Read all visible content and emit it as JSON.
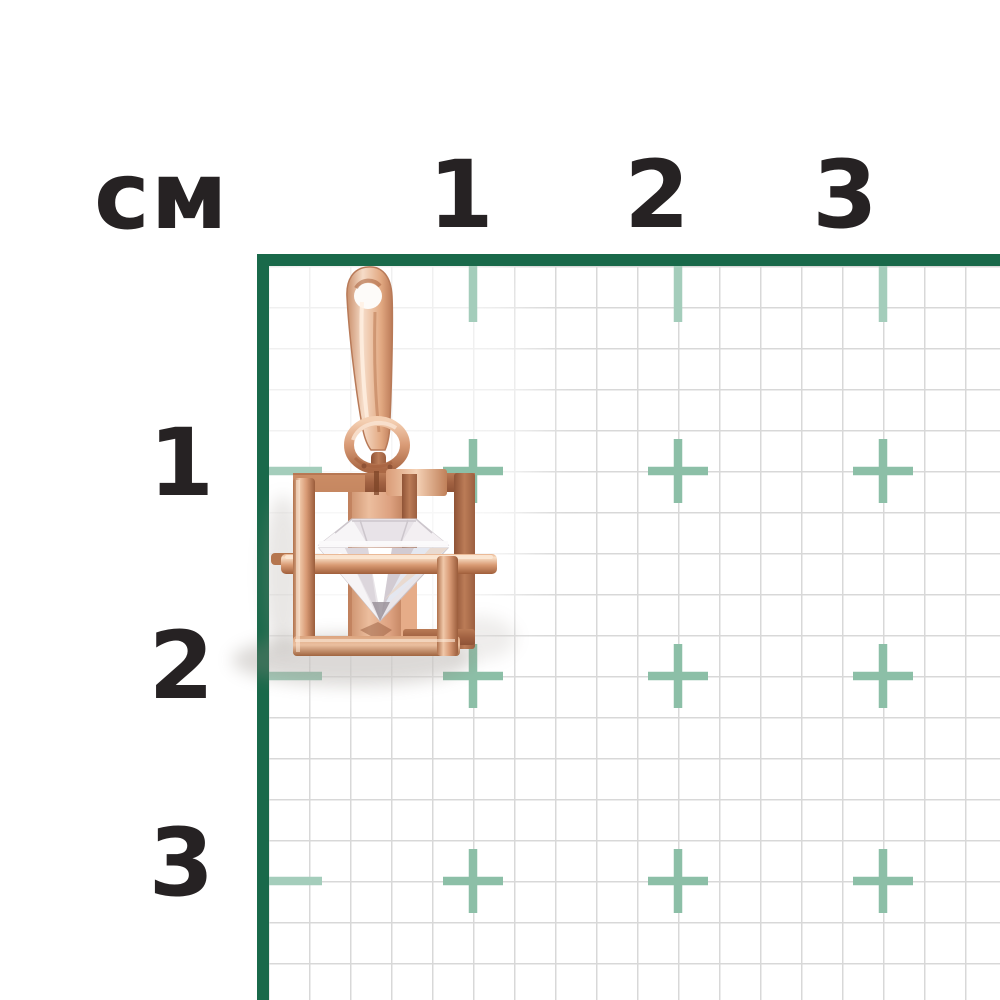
{
  "ruler": {
    "unit_label": "см",
    "top_ticks": [
      "1",
      "2",
      "3"
    ],
    "left_ticks": [
      "1",
      "2",
      "3"
    ],
    "cm_spacing_px": 205,
    "small_cell_mm": 2,
    "colors": {
      "frame_green": "#19694a",
      "cross_marks": "#8cbfa7",
      "edge_ticks": "#a4cdbb",
      "grid_lines": "#d8d8d8",
      "label_text": "#262223",
      "background": "#ffffff"
    }
  },
  "subject": {
    "kind": "jewelry pendant photograph",
    "description": "Rose-gold open cube cage pendant with a round clear crystal inside, teardrop bail and jump ring, about 1 cm wide",
    "metal_color": "#dd9d7a",
    "stone_color": "#f3f1f4",
    "approx_width_cm": 1,
    "approx_height_cm": 2
  }
}
